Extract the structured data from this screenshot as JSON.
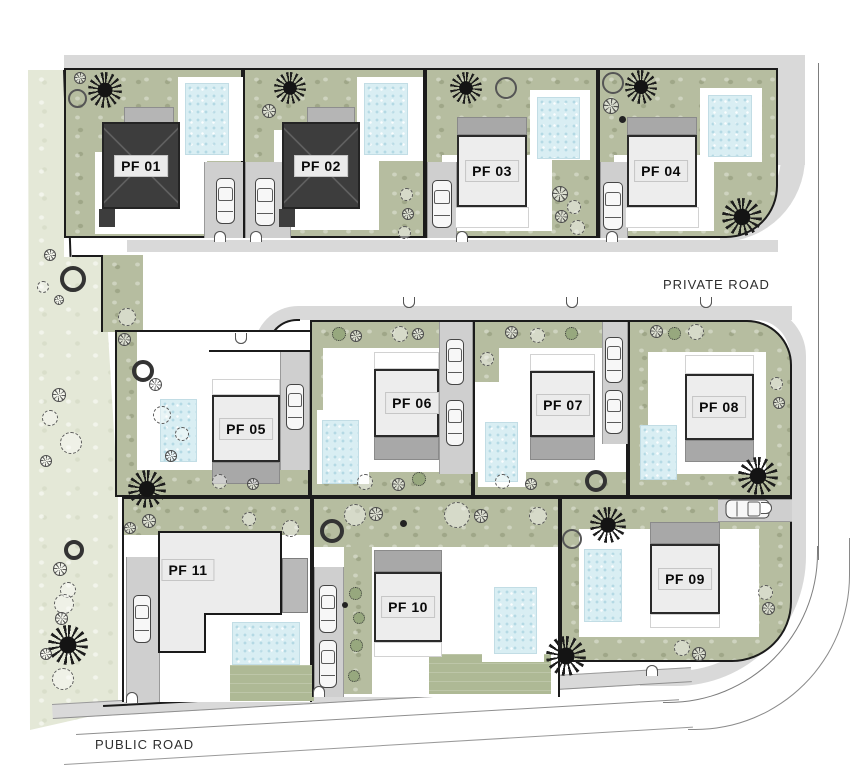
{
  "plan": {
    "road_labels": {
      "private": "PRIVATE ROAD",
      "public": "PUBLIC ROAD"
    },
    "plots": [
      {
        "id": "pf-01",
        "label": "PF 01",
        "house_style": "dark-hip-roof"
      },
      {
        "id": "pf-02",
        "label": "PF 02",
        "house_style": "dark-hip-roof"
      },
      {
        "id": "pf-03",
        "label": "PF 03",
        "house_style": "flat-roof"
      },
      {
        "id": "pf-04",
        "label": "PF 04",
        "house_style": "flat-roof"
      },
      {
        "id": "pf-05",
        "label": "PF 05",
        "house_style": "flat-roof"
      },
      {
        "id": "pf-06",
        "label": "PF 06",
        "house_style": "flat-roof"
      },
      {
        "id": "pf-07",
        "label": "PF 07",
        "house_style": "flat-roof"
      },
      {
        "id": "pf-08",
        "label": "PF 08",
        "house_style": "flat-roof"
      },
      {
        "id": "pf-09",
        "label": "PF 09",
        "house_style": "flat-roof"
      },
      {
        "id": "pf-10",
        "label": "PF 10",
        "house_style": "flat-roof"
      },
      {
        "id": "pf-11",
        "label": "PF 11",
        "house_style": "flat-l-shape"
      }
    ],
    "legend_colors": {
      "garden": "#b6bda0",
      "buffer_green": "#e4e8d7",
      "pool_water": "#d9eef3",
      "road": "#d9d9d9",
      "driveway": "#cfcfcf",
      "dark_roof": "#3d3d3d",
      "flat_roof_body": "#ededed",
      "roof_band": "#a8a8a8",
      "boundary_line": "#1b1b1b"
    }
  }
}
